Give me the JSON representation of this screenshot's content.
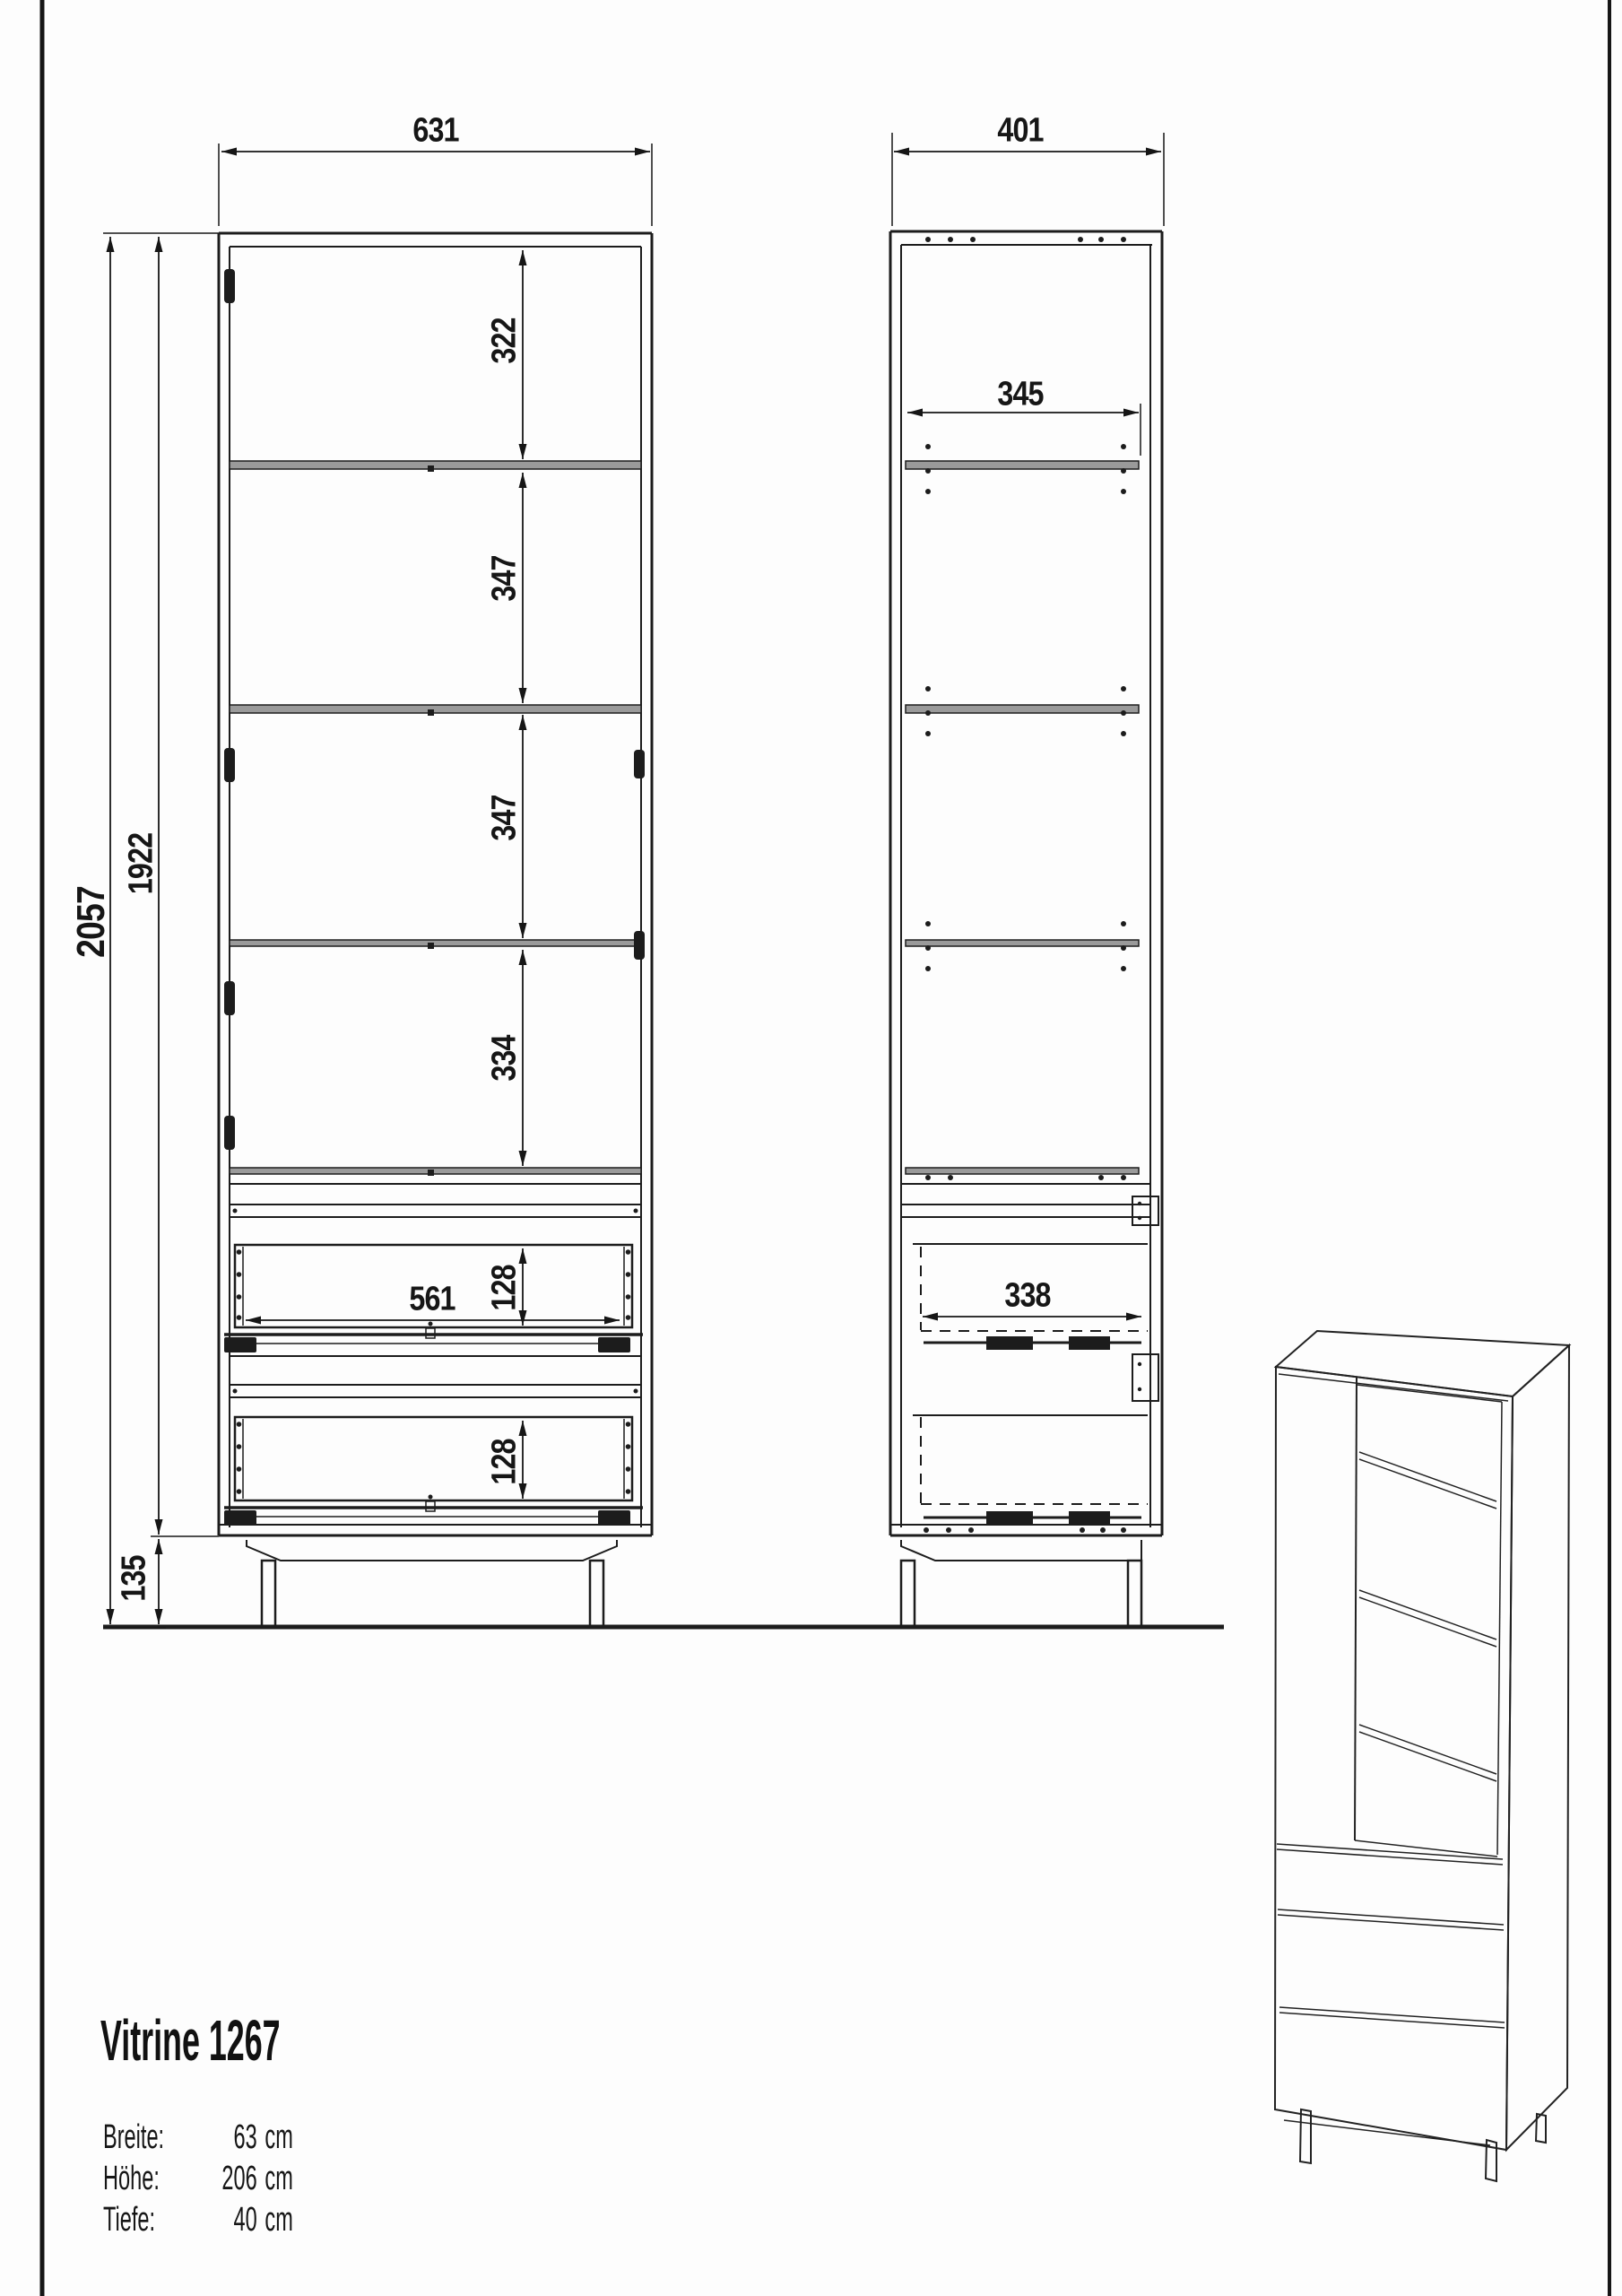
{
  "page": {
    "product_title": "Vitrine 1267",
    "specs": [
      {
        "label": "Breite:",
        "value": "63",
        "unit": "cm"
      },
      {
        "label": "Höhe:",
        "value": "206",
        "unit": "cm"
      },
      {
        "label": "Tiefe:",
        "value": "40",
        "unit": "cm"
      }
    ]
  },
  "front_view": {
    "width": "631",
    "total_height": "2057",
    "body_height": "1922",
    "leg_height": "135",
    "sections": [
      "322",
      "347",
      "347",
      "334"
    ],
    "drawer_inner_width": "561",
    "drawer_heights": [
      "128",
      "128"
    ]
  },
  "side_view": {
    "depth": "401",
    "shelf_depth": "345",
    "drawer_depth": "338"
  }
}
